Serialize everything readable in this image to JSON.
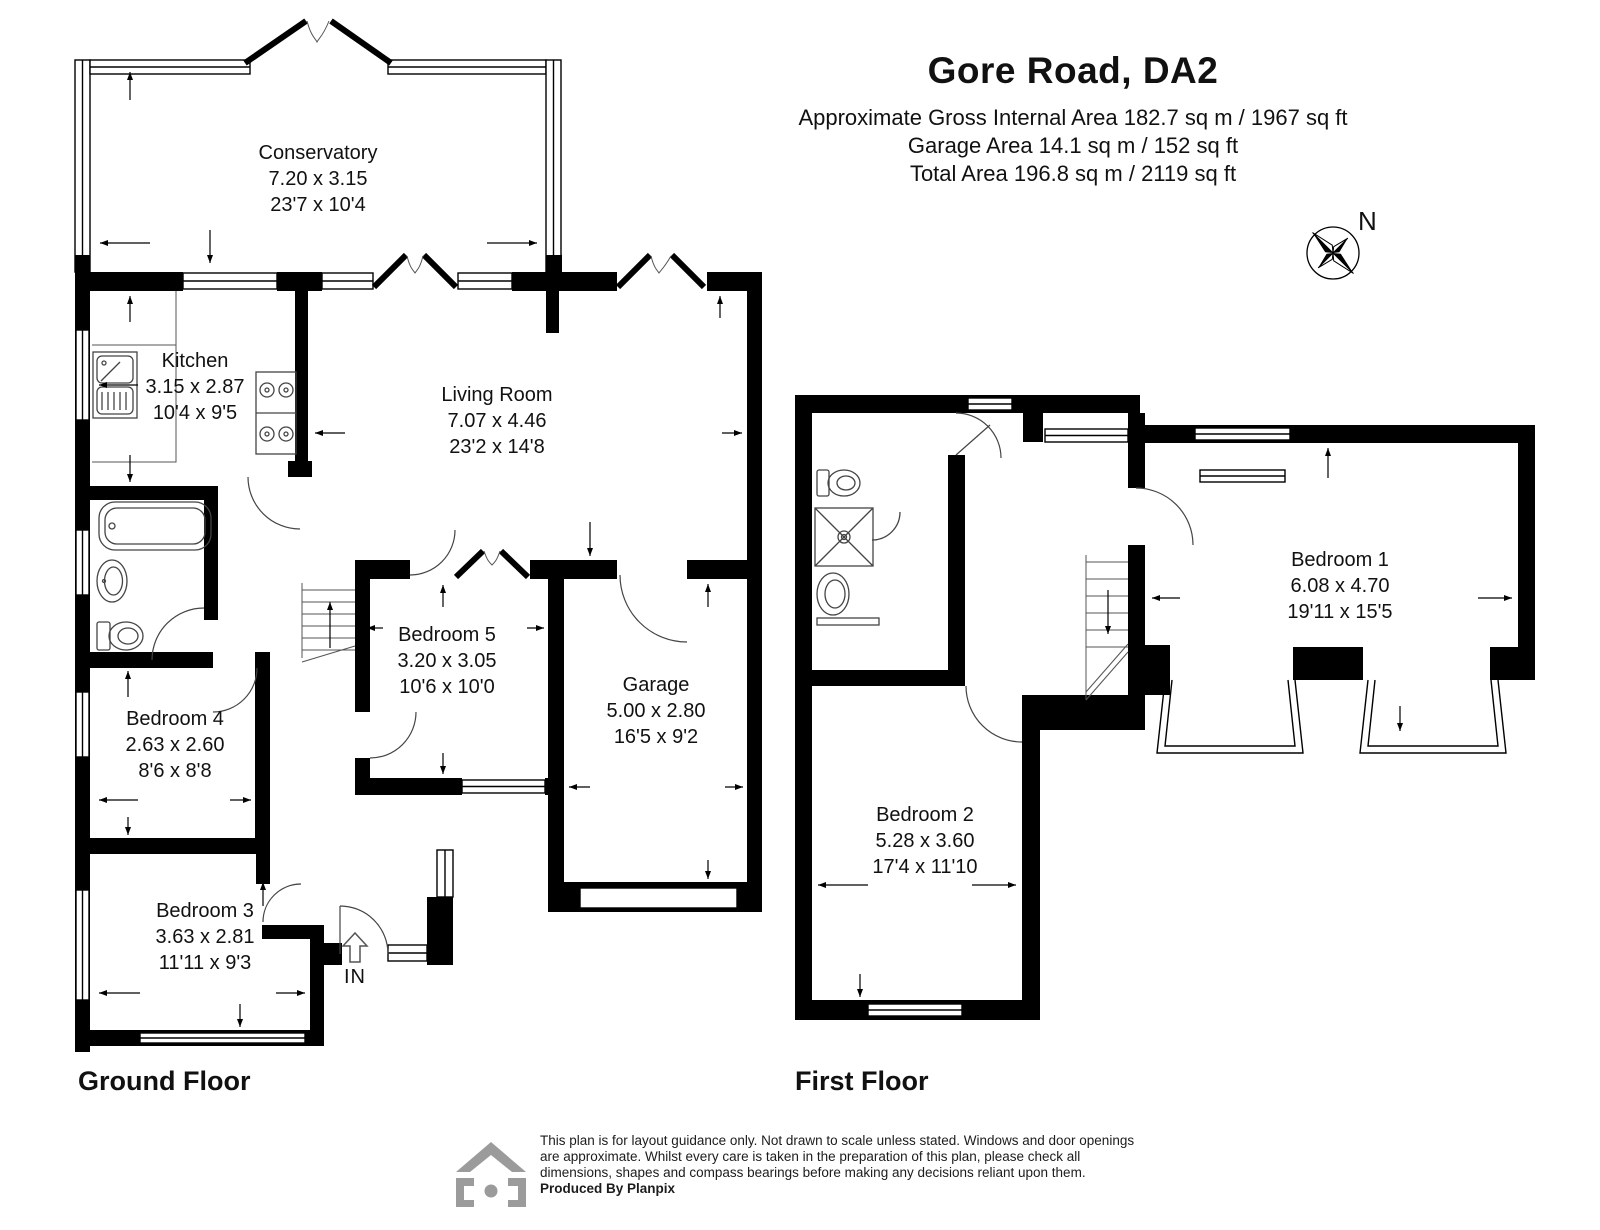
{
  "header": {
    "title": "Gore Road, DA2",
    "area_lines": [
      "Approximate Gross Internal Area 182.7 sq m / 1967 sq ft",
      "Garage Area 14.1 sq m / 152 sq ft",
      "Total Area 196.8 sq m / 2119 sq ft"
    ]
  },
  "compass": {
    "north_label": "N"
  },
  "ground_floor": {
    "label": "Ground Floor",
    "entrance_label": "IN",
    "rooms": [
      {
        "name": "Conservatory",
        "dim_m": "7.20 x 3.15",
        "dim_ft": "23'7 x 10'4"
      },
      {
        "name": "Kitchen",
        "dim_m": "3.15 x 2.87",
        "dim_ft": "10'4 x 9'5"
      },
      {
        "name": "Living Room",
        "dim_m": "7.07 x 4.46",
        "dim_ft": "23'2 x 14'8"
      },
      {
        "name": "Bedroom 5",
        "dim_m": "3.20 x 3.05",
        "dim_ft": "10'6 x 10'0"
      },
      {
        "name": "Garage",
        "dim_m": "5.00 x 2.80",
        "dim_ft": "16'5 x 9'2"
      },
      {
        "name": "Bedroom 4",
        "dim_m": "2.63 x 2.60",
        "dim_ft": "8'6 x 8'8"
      },
      {
        "name": "Bedroom 3",
        "dim_m": "3.63 x 2.81",
        "dim_ft": "11'11 x 9'3"
      }
    ]
  },
  "first_floor": {
    "label": "First Floor",
    "rooms": [
      {
        "name": "Bedroom 1",
        "dim_m": "6.08 x 4.70",
        "dim_ft": "19'11 x 15'5"
      },
      {
        "name": "Bedroom 2",
        "dim_m": "5.28 x 3.60",
        "dim_ft": "17'4 x 11'10"
      }
    ]
  },
  "footer": {
    "disclaimer_lines": [
      "This plan is for layout guidance only. Not drawn to scale unless stated. Windows and door openings",
      "are approximate. Whilst every care is taken in the preparation of this plan, please check all",
      "dimensions, shapes and compass bearings before making any decisions reliant upon them."
    ],
    "produced_by": "Produced By Planpix"
  }
}
